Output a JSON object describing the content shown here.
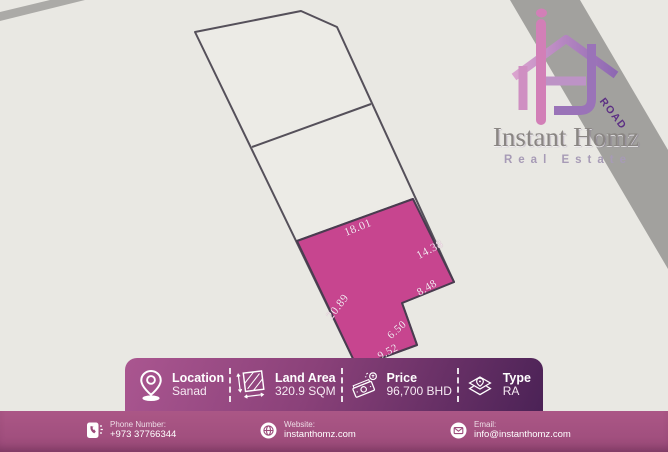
{
  "brand": {
    "name": "Instant Homz",
    "tagline": "Real Estate",
    "road_label": "ROAD"
  },
  "site_plan": {
    "measurements": [
      "18.01",
      "14.38",
      "8.48",
      "20.89",
      "6.50",
      "9.52"
    ],
    "highlighted_plot_color": "#c7458f",
    "road_color": "#a2a19e",
    "outline_color": "#4f4a50"
  },
  "info_bar": {
    "items": [
      {
        "icon": "location-pin-icon",
        "label": "Location",
        "value": "Sanad"
      },
      {
        "icon": "area-icon",
        "label": "Land Area",
        "value": "320.9 SQM"
      },
      {
        "icon": "money-icon",
        "label": "Price",
        "value": "96,700 BHD"
      },
      {
        "icon": "map-type-icon",
        "label": "Type",
        "value": "RA"
      }
    ],
    "gradient": [
      "#aa5690",
      "#4b2256"
    ]
  },
  "contact_bar": {
    "background": "#a4527f",
    "items": [
      {
        "icon": "phone-icon",
        "label": "Phone Number:",
        "value": "+973 37766344"
      },
      {
        "icon": "globe-icon",
        "label": "Website:",
        "value": "instanthomz.com"
      },
      {
        "icon": "email-icon",
        "label": "Email:",
        "value": "info@instanthomz.com"
      }
    ]
  }
}
